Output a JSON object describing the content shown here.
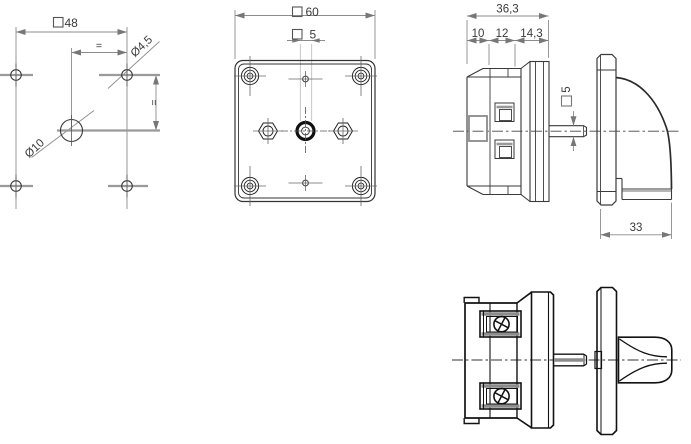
{
  "drawing": {
    "title": "rotary-switch-technical-drawing",
    "background": "#ffffff",
    "colors": {
      "outline": "#3a3a3a",
      "outline_heavy": "#121212",
      "dimension_line": "#8c8c8c",
      "centerline_stub": "#9a9a9a",
      "arrow": "#777777",
      "text": "#3a3a3a"
    },
    "views": {
      "mounting_hole_plan": {
        "label": "drilling-plan-view",
        "dimensions": {
          "plate_square": {
            "symbol": "square",
            "value": "48"
          },
          "hole_spacing_horizontal": "=",
          "hole_spacing_vertical": "=",
          "corner_hole_diameter": "Ø4,5",
          "center_hole_diameter": "Ø10"
        }
      },
      "front_view": {
        "label": "front-view",
        "dimensions": {
          "plate_square": {
            "symbol": "square",
            "value": "60"
          },
          "shaft_square": {
            "symbol": "square",
            "value": "5"
          }
        }
      },
      "side_view": {
        "label": "side-view-with-knob",
        "dimensions": {
          "total_depth": "36,3",
          "rear_depth": "10",
          "mid_depth": "12",
          "front_depth": "14,3",
          "shaft_square": {
            "symbol": "square",
            "value": "5"
          },
          "knob_depth": "33"
        }
      },
      "bottom_view": {
        "label": "bottom-view-with-knob",
        "dimensions": {}
      }
    }
  }
}
